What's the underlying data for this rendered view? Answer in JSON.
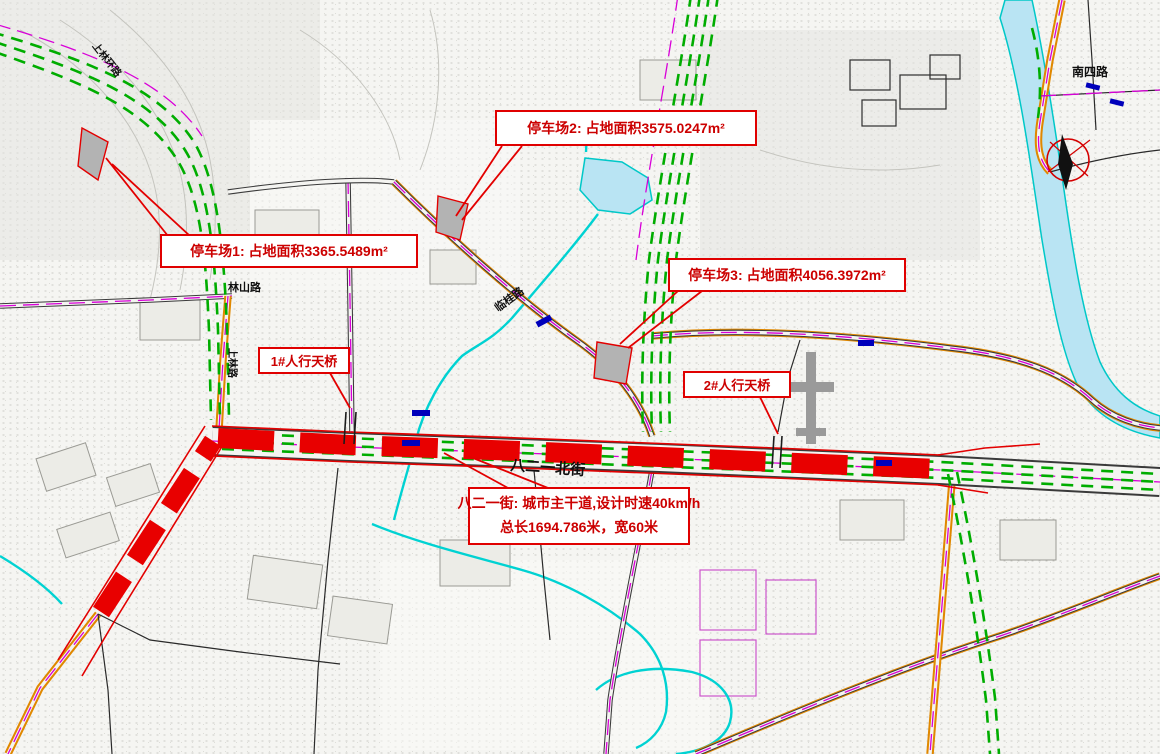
{
  "map": {
    "callouts": {
      "parking2": "停车场2: 占地面积3575.0247m²",
      "parking1": "停车场1: 占地面积3365.5489m²",
      "parking3": "停车场3: 占地面积4056.3972m²",
      "bridge1": "1#人行天桥",
      "bridge2": "2#人行天桥",
      "road_info_line1": "八二一街: 城市主干道,设计时速40km/h",
      "road_info_line2": "总长1694.786米，宽60米"
    },
    "street_labels": {
      "bayiyi_north_street": "八二一北街",
      "linshan_road": "林山路",
      "nansi_road": "南四路",
      "shanglin_road": "上林路",
      "lingui_road": "临桂路",
      "shanglin_ring_road": "上林环路"
    },
    "colors": {
      "planned_road_red": "#e80000",
      "callout_border_red": "#e00000",
      "callout_text_red": "#cc0000",
      "corridor_green": "#00ad00",
      "water_cyan": "#00d2d2",
      "water_fill": "#b9e4f3",
      "centerline_magenta": "#d800d8",
      "road_edge_orange": "#e08800",
      "parking_fill_gray": "#b3b3b3",
      "bus_stop_blue": "#0000bb"
    }
  }
}
